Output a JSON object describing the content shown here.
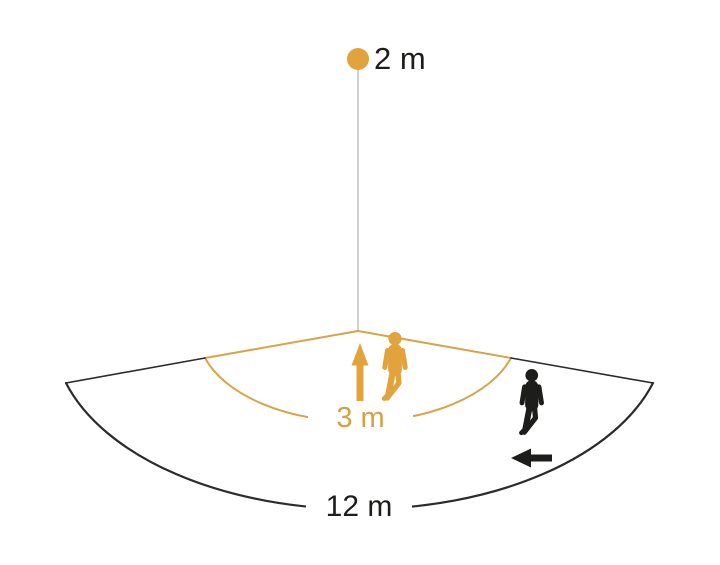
{
  "diagram": {
    "labels": {
      "mounting_height": "2 m",
      "inner_range": "3 m",
      "outer_range": "12 m"
    },
    "colors": {
      "orange": "#E2A33C",
      "orange_line": "#D7A449",
      "black": "#1D1D1B",
      "dark_edge": "#2B2B29",
      "gray_leader": "#B0B0B0",
      "background": "#FFFFFF"
    },
    "icons": {
      "sensor_dot": "filled-circle",
      "inner_person": "walking-person",
      "outer_person": "walking-person",
      "inner_arrow": "arrow-up",
      "outer_arrow": "arrow-left"
    }
  }
}
